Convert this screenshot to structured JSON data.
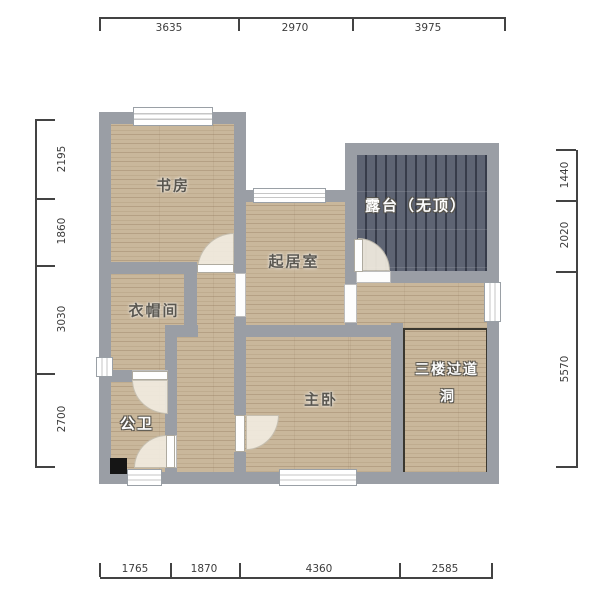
{
  "plan": {
    "rooms": {
      "study": "书房",
      "living": "起居室",
      "terrace": "露台（无顶）",
      "cloakroom": "衣帽间",
      "bathroom": "公卫",
      "master": "主卧",
      "hole_line1": "三楼过道",
      "hole_line2": "洞"
    },
    "dims": {
      "top": [
        "3635",
        "2970",
        "3975"
      ],
      "left": [
        "2195",
        "1860",
        "3030",
        "2700"
      ],
      "right": [
        "1440",
        "2020",
        "5570"
      ],
      "bottom": [
        "1765",
        "1870",
        "4360",
        "2585"
      ]
    },
    "colors": {
      "wall": "#9a9ea5",
      "floor": "#c9b79b",
      "deck": "#5e6473",
      "label_dark": "#5a5750",
      "label_light": "#fdfdfd",
      "dim_text": "#3c3c3c",
      "shaft": "#151515"
    }
  }
}
